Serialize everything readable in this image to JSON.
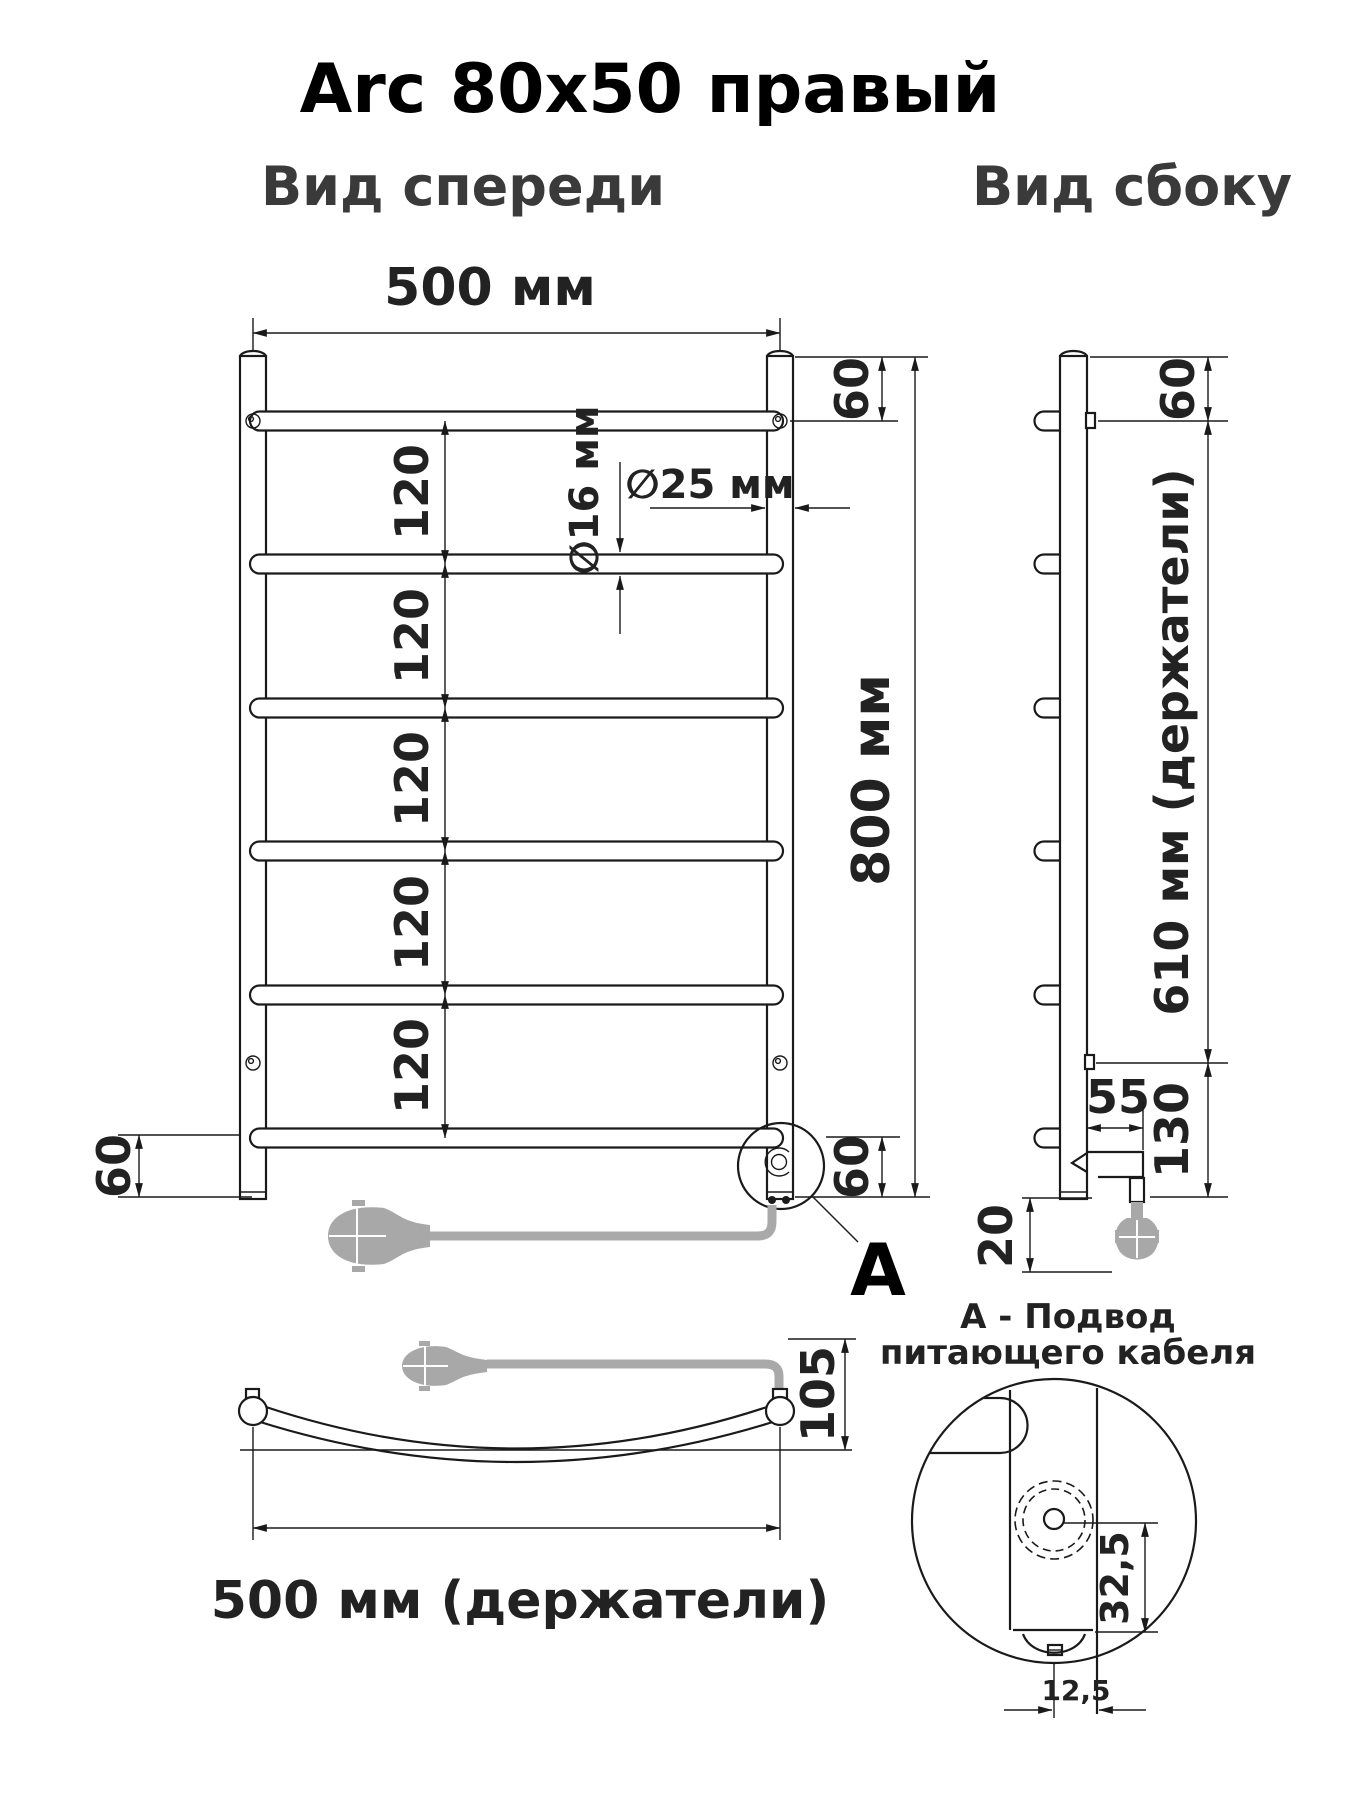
{
  "title": "Arc 80x50 правый",
  "front": {
    "label": "Вид спереди",
    "dim_width": "500 мм",
    "dim_height": "800 мм",
    "dim_top": "60",
    "dim_gap": "120",
    "dim_bottom_left": "60",
    "dim_bottom_right": "60",
    "dim_rung_dia": "∅16 мм",
    "dim_post_dia": "∅25 мм"
  },
  "side": {
    "label": "Вид сбоку",
    "dim_top": "60",
    "dim_holders": "610 мм (держатели)",
    "dim_cable": "55",
    "dim_bottom": "130",
    "dim_drop": "20"
  },
  "bottom_view": {
    "dim_holders": "500 мм (держатели)",
    "dim_depth": "105"
  },
  "detail": {
    "callout": "А",
    "dim_v": "32,5",
    "dim_h": "12,5",
    "note1": "А - Подвод",
    "note2": "питающего кабеля"
  },
  "colors": {
    "line": "#1a1a1a",
    "cable": "#a9a9a9"
  }
}
